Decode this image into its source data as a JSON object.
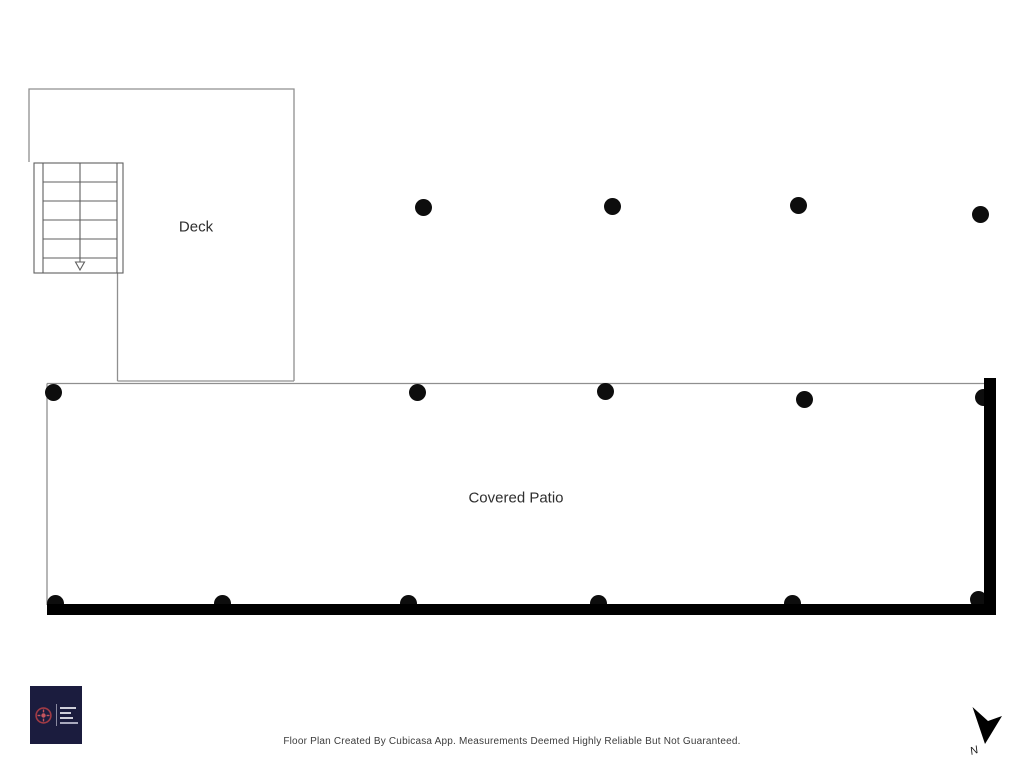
{
  "plan": {
    "type": "floor-plan",
    "floor": "deck-and-patio-level",
    "rooms": [
      {
        "label": "Deck"
      },
      {
        "label": "Covered Patio"
      }
    ]
  },
  "dots": {
    "description": "support posts shown as filled circles",
    "diameter": 17,
    "color": "#0d0d0d",
    "positions": [
      {
        "x": 423,
        "y": 207
      },
      {
        "x": 612,
        "y": 206
      },
      {
        "x": 798,
        "y": 205
      },
      {
        "x": 980,
        "y": 214
      },
      {
        "x": 53,
        "y": 392
      },
      {
        "x": 417,
        "y": 392
      },
      {
        "x": 605,
        "y": 391
      },
      {
        "x": 804,
        "y": 399
      },
      {
        "x": 983,
        "y": 397
      },
      {
        "x": 55,
        "y": 603
      },
      {
        "x": 222,
        "y": 603
      },
      {
        "x": 408,
        "y": 603
      },
      {
        "x": 598,
        "y": 603
      },
      {
        "x": 792,
        "y": 603
      },
      {
        "x": 978,
        "y": 599
      }
    ]
  },
  "compass": {
    "label": "N"
  },
  "footer": {
    "disclaimer": "Floor Plan Created By Cubicasa App. Measurements Deemed Highly Reliable But Not Guaranteed."
  },
  "colors": {
    "wall_thin": "#8f8f8f",
    "stair_line": "#5f5f5f",
    "wall_thick": "#000000",
    "label_text": "#2e2e2e",
    "footer_text": "#3c3c3c",
    "logo_background": "#1b1c3e",
    "logo_emblem": "#a03a44"
  }
}
